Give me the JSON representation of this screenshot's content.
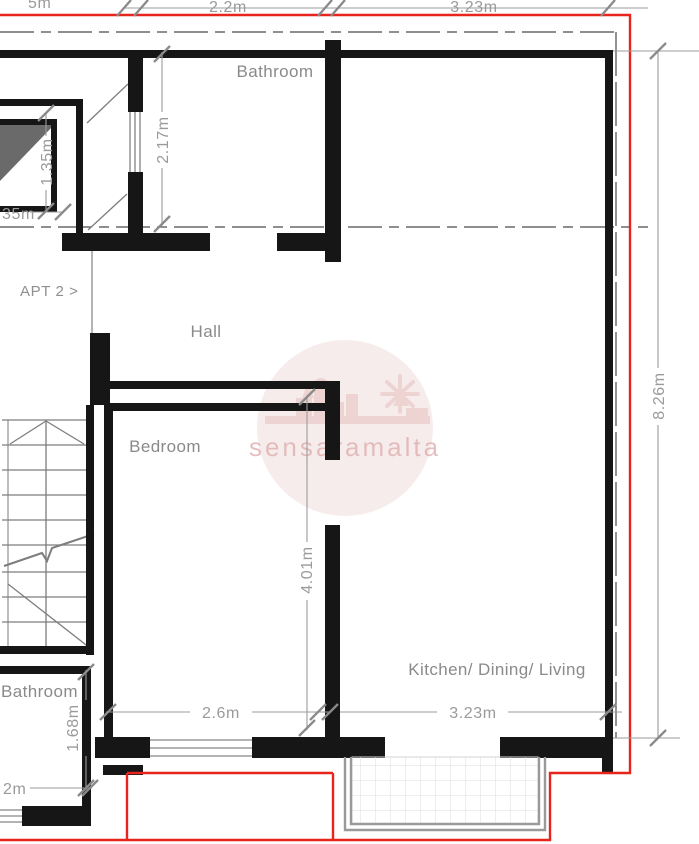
{
  "plan": {
    "title": "Apartment floor plan",
    "apartment_marker": "APT 2 >",
    "rooms": {
      "bathroom_top": "Bathroom",
      "hall": "Hall",
      "bedroom": "Bedroom",
      "kitchen": "Kitchen/ Dining/ Living",
      "bathroom_bottom": "Bathroom"
    },
    "dimensions": {
      "top_left_partial": "5m",
      "top_width_1": "2.2m",
      "top_width_2": "3.23m",
      "bathroom_height": "2.17m",
      "shaft_height": "1.35m",
      "shaft_width_partial": "35m",
      "right_height": "8.26m",
      "bedroom_height": "4.01m",
      "bedroom_width": "2.6m",
      "kitchen_width": "3.23m",
      "bathroom2_height": "1.68m",
      "bathroom2_width_partial": "2m"
    },
    "watermark": {
      "text": "sensaramalta"
    },
    "colors": {
      "wall": "#161616",
      "dimension_gray": "#9a9a9a",
      "red_outline": "#e8251d",
      "watermark_pink": "#f0dcdc",
      "watermark_text_pink": "#dfb0b0",
      "shaft_fill": "#6a6a6a"
    }
  }
}
